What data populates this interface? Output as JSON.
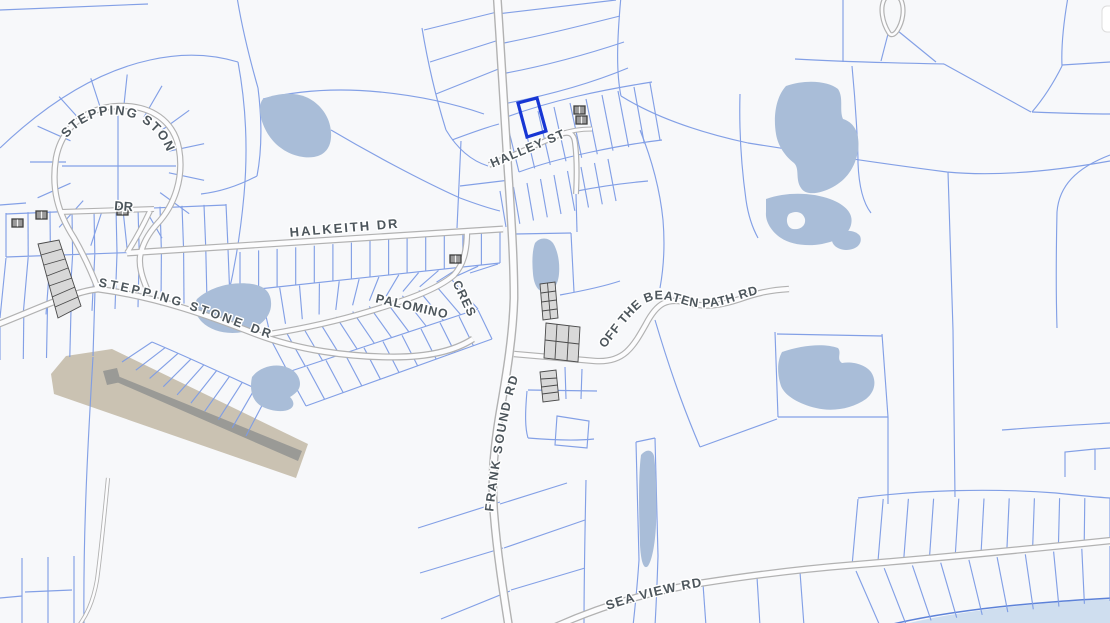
{
  "map": {
    "kind": "cadastral-parcel-map",
    "road_labels": {
      "halley_st": "HALLEY ST",
      "halkeith_dr": "HALKEITH DR",
      "stepping_stone_loop_line1": "STEPPING STONE",
      "stepping_stone_loop_line2": "DR",
      "stepping_stone_dr": "STEPPING STONE DR",
      "palomino_cres_part1": "PALOMINO",
      "palomino_cres_part2": "CRES",
      "frank_sound_rd": "FRANK SOUND RD",
      "off_the_beaten_path_rd": "OFF THE BEATEN PATH RD",
      "sea_view_rd": "SEA VIEW RD"
    },
    "selected_parcel": {
      "highlighted": true
    },
    "colors": {
      "background": "#f7f8fa",
      "parcel_line": "#7d9ce5",
      "parcel_line_strong": "#5d82d8",
      "road_fill": "#fcfcfd",
      "road_casing": "#b2b2b2",
      "water": "#a9bdd8",
      "sea": "#cfdeef",
      "airstrip": "#cac2b2",
      "runway": "#9a9a96",
      "strata_fill": "#d8d8d8",
      "strata_outline": "#4a4a4a",
      "building": "#9a9a9a",
      "label_text": "#4d565c",
      "selected_parcel": "#1736d4"
    }
  }
}
